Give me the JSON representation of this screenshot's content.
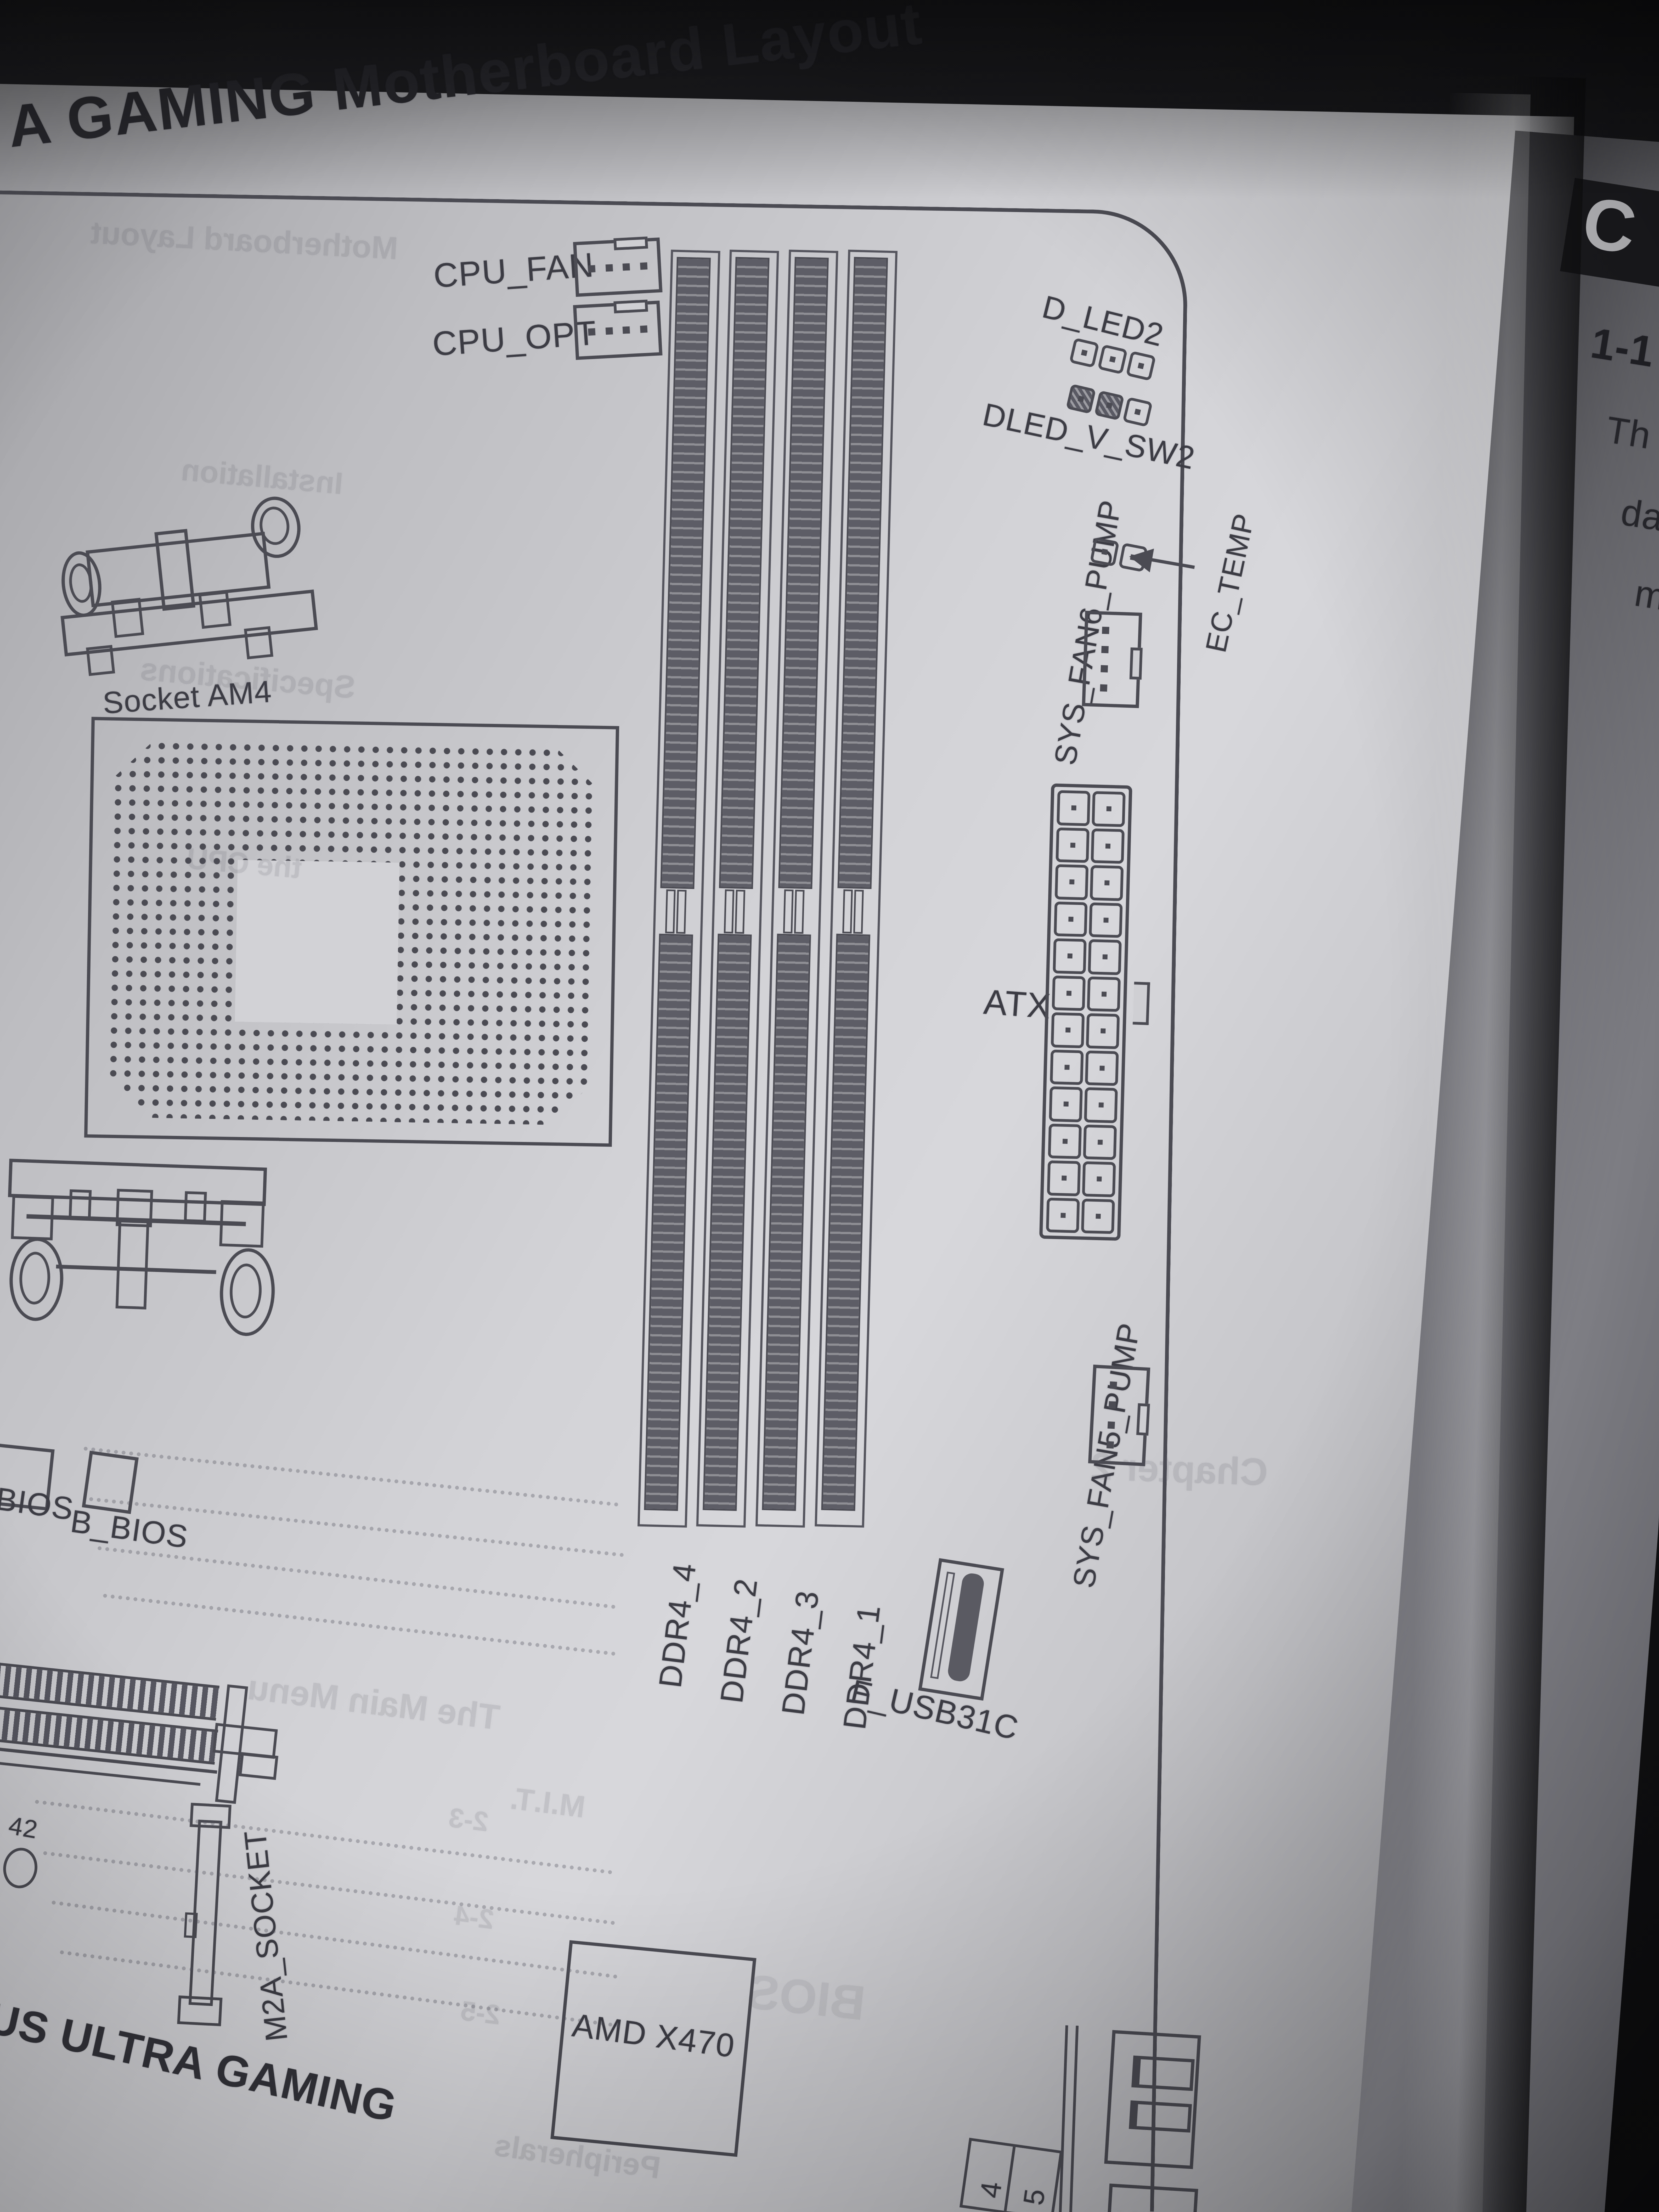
{
  "page": {
    "title": "A GAMING Motherboard Layout",
    "board": {
      "cpu_fan_label": "CPU_FAN",
      "cpu_opt_label": "CPU_OPT",
      "d_led2_label": "D_LED2",
      "dled_v_sw2_label": "DLED_V_SW2",
      "sys_fan6_label": "SYS_FAN6_PUMP",
      "ec_temp_label": "EC_TEMP",
      "atx_label": "ATX",
      "sys_fan5_label": "SYS_FAN5_PUMP",
      "dimm_labels": [
        "DDR4_4",
        "DDR4_2",
        "DDR4_3",
        "DDR4_1"
      ],
      "usb_c_header_label": "F_USB31C",
      "socket_label": "Socket AM4",
      "bios_label": "BIOS",
      "b_bios_label": "B_BIOS",
      "m2_label": "M2A_SOCKET",
      "chipset_label": "AMD X470",
      "board_name_fragment": "US ULTRA GAMING",
      "mounting_hole_number": "42",
      "sata_port_numbers": [
        "4",
        "5"
      ]
    },
    "bleedthrough": {
      "b1": "Motherboard Layout",
      "b2": "Installation",
      "b3": "Specifications",
      "b4": "the CPU",
      "b5": "Chapter 2",
      "b6": "The Main Menu",
      "b7": "M.I.T.",
      "b8": "2-3",
      "b9": "2-4",
      "b10": "2-5",
      "b11": "BIOS",
      "b12": "Peripherals"
    }
  },
  "next_page": {
    "chapter_initial": "C",
    "section_number": "1-1",
    "text_fragments": [
      "Th",
      "da",
      "m"
    ]
  }
}
